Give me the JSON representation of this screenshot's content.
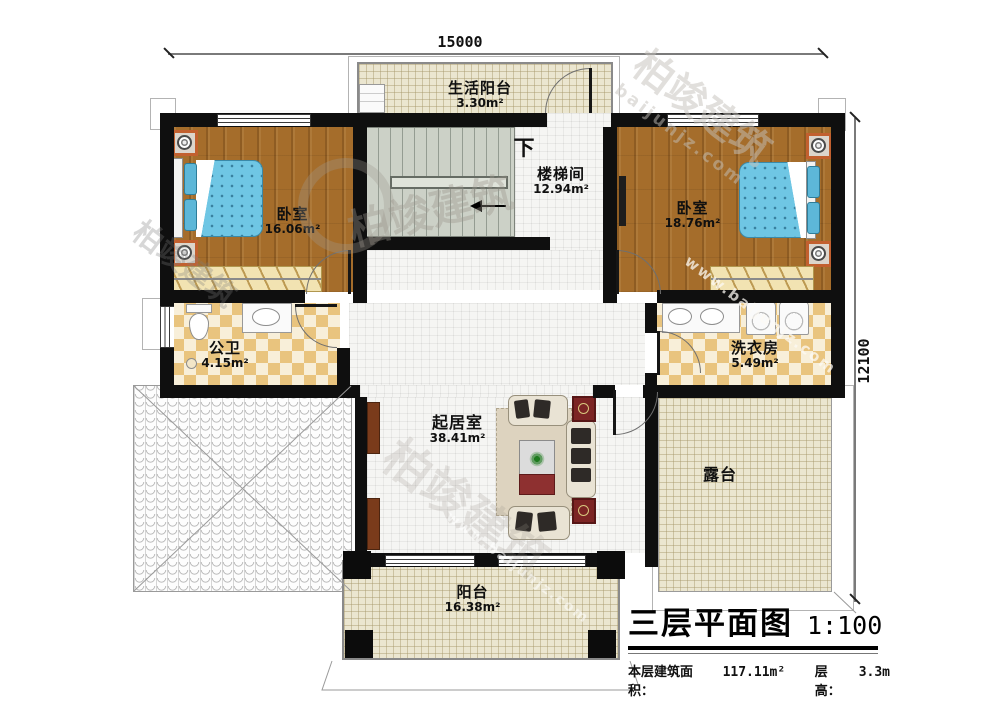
{
  "dimensions": {
    "width_mm": "15000",
    "height_mm": "12100"
  },
  "rooms": {
    "life_balcony": {
      "name": "生活阳台",
      "area": "3.30m²"
    },
    "stairwell": {
      "name": "楼梯间",
      "area": "12.94m²",
      "down": "下"
    },
    "bedroom_left": {
      "name": "卧室",
      "area": "16.06m²"
    },
    "bedroom_right": {
      "name": "卧室",
      "area": "18.76m²"
    },
    "bathroom": {
      "name": "公卫",
      "area": "4.15m²"
    },
    "laundry": {
      "name": "洗衣房",
      "area": "5.49m²"
    },
    "living": {
      "name": "起居室",
      "area": "38.41m²"
    },
    "terrace": {
      "name": "露台"
    },
    "balcony": {
      "name": "阳台",
      "area": "16.38m²"
    }
  },
  "title_block": {
    "title": "三层平面图",
    "scale": "1:100",
    "area_label": "本层建筑面积：",
    "area_value": "117.11m²",
    "height_label": "层高：",
    "height_value": "3.3m"
  },
  "watermark": {
    "brand": "柏竣建筑",
    "domain": "baijunjz.com",
    "domain_www": "www.baijunjz.com"
  },
  "colors": {
    "wall": "#0f0f0f",
    "wood_floor": "#a56d2b",
    "bed": "#6fc6e4",
    "tile_accent": "#e9c47e",
    "stair": "#ccd1c7",
    "terrace_floor": "#ebe6d0",
    "accent_red": "#7c2424"
  }
}
